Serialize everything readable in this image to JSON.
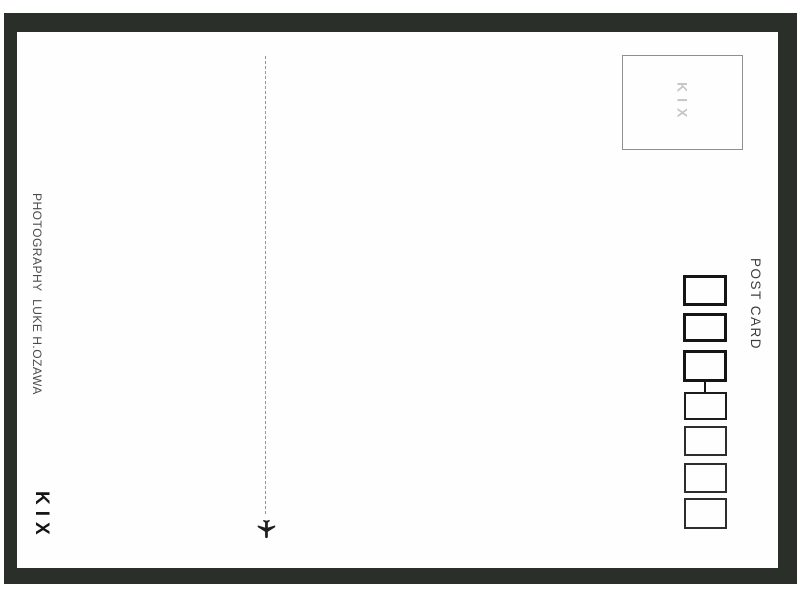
{
  "colors": {
    "frame": "#2a2f2a",
    "card": "#fefefe",
    "ink": "#151515",
    "stamp_text": "#c6c6c6",
    "credit_text": "#4b4b4b"
  },
  "left_rail": {
    "credit": "PHOTOGRAPHY  LUKE H.OZAWA",
    "logo": "KIX"
  },
  "stamp": {
    "label": "KIX"
  },
  "right_rail": {
    "title": "POST CARD"
  },
  "divider": {
    "style": "dashed-vertical",
    "icon": "airplane-down"
  },
  "postal_code": {
    "box_count": 7,
    "thick_border_boxes": 3,
    "thin_border_boxes": 4
  }
}
